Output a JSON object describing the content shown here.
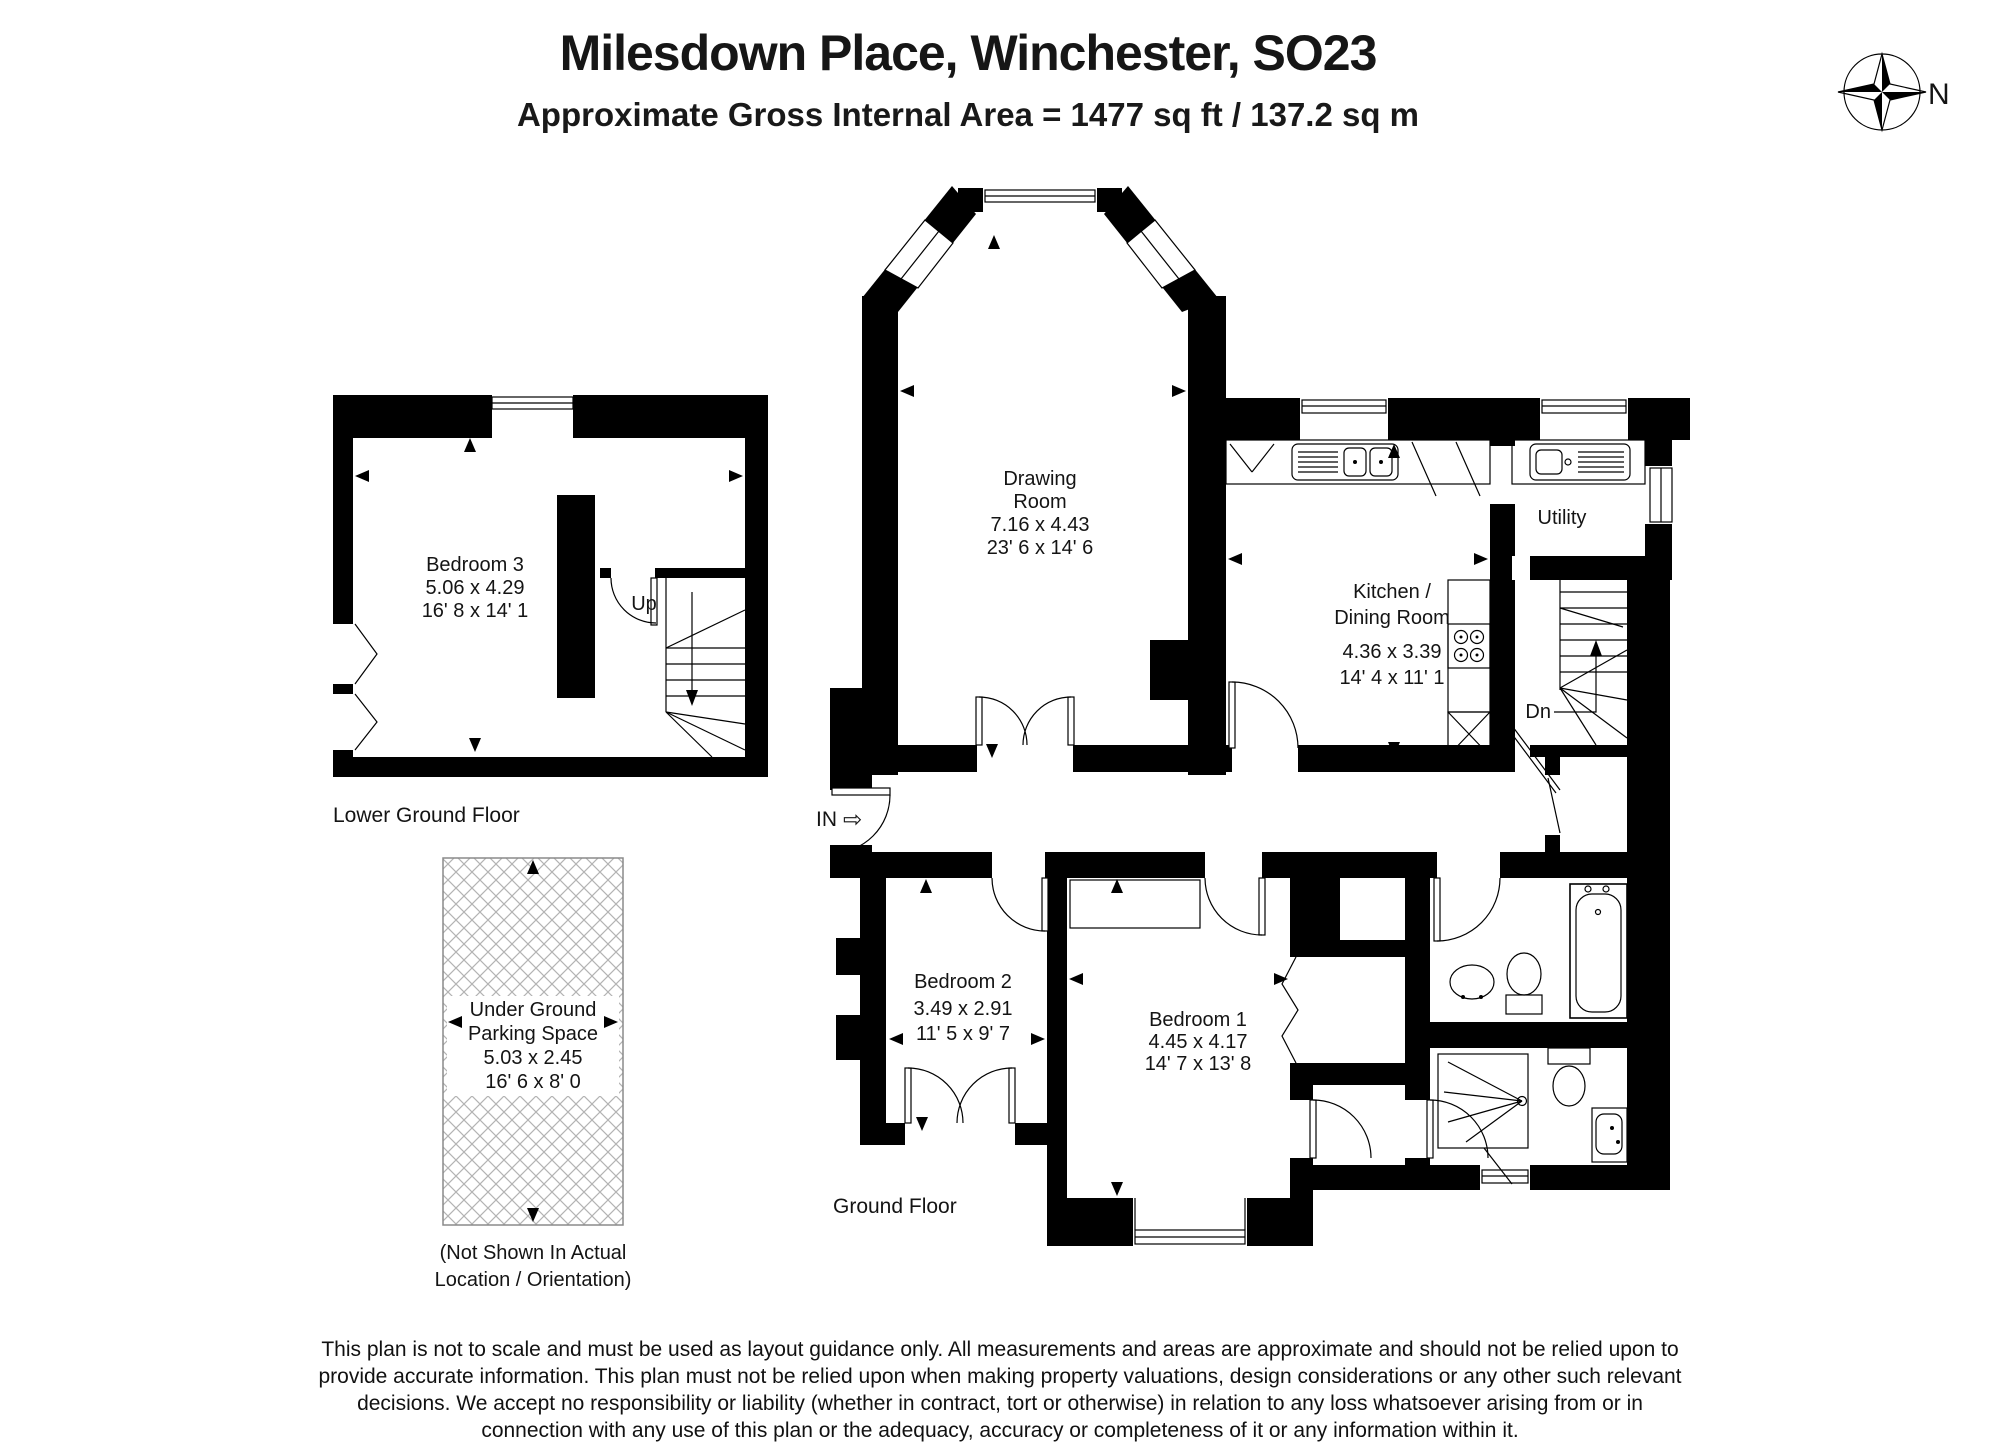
{
  "colors": {
    "wall": "#000000",
    "hatch": "#b3b3b3",
    "text": "#141414"
  },
  "header": {
    "title": "Milesdown Place, Winchester, SO23",
    "subtitle": "Approximate Gross Internal Area = 1477 sq ft / 137.2 sq m"
  },
  "compass": {
    "label": "N"
  },
  "floors": {
    "lower_ground": {
      "label": "Lower Ground Floor",
      "stairs_label": "Up",
      "rooms": {
        "bedroom3": {
          "lines": [
            "Bedroom 3",
            "5.06 x 4.29",
            "16' 8 x 14' 1"
          ]
        }
      }
    },
    "ground": {
      "label": "Ground Floor",
      "stairs_label": "Dn",
      "entrance": {
        "label": "IN",
        "arrow": "⇨"
      },
      "rooms": {
        "drawing_room": {
          "lines": [
            "Drawing",
            "Room",
            "7.16 x 4.43",
            "23' 6 x 14' 6"
          ]
        },
        "kitchen_dining": {
          "lines": [
            "Kitchen /",
            "Dining Room",
            "4.36 x 3.39",
            "14' 4 x 11' 1"
          ]
        },
        "utility": {
          "lines": [
            "Utility"
          ]
        },
        "bedroom2": {
          "lines": [
            "Bedroom 2",
            "3.49 x 2.91",
            "11' 5 x 9' 7"
          ]
        },
        "bedroom1": {
          "lines": [
            "Bedroom 1",
            "4.45 x 4.17",
            "14' 7 x 13' 8"
          ]
        }
      }
    }
  },
  "parking": {
    "lines": [
      "Under Ground",
      "Parking Space",
      "5.03 x 2.45",
      "16' 6 x 8' 0"
    ],
    "note": [
      "(Not Shown In Actual",
      "Location / Orientation)"
    ]
  },
  "disclaimer": {
    "lines": [
      "This plan is not to scale and must be used as layout guidance only. All measurements and areas are approximate and should not be relied upon to",
      "provide accurate information. This plan must not be relied upon when making property valuations, design considerations or any other such relevant",
      "decisions. We accept no responsibility or liability (whether in contract, tort or otherwise) in relation to any loss whatsoever arising from or in",
      "connection with any use of this plan or the adequacy, accuracy or completeness of it or any information within it."
    ]
  }
}
